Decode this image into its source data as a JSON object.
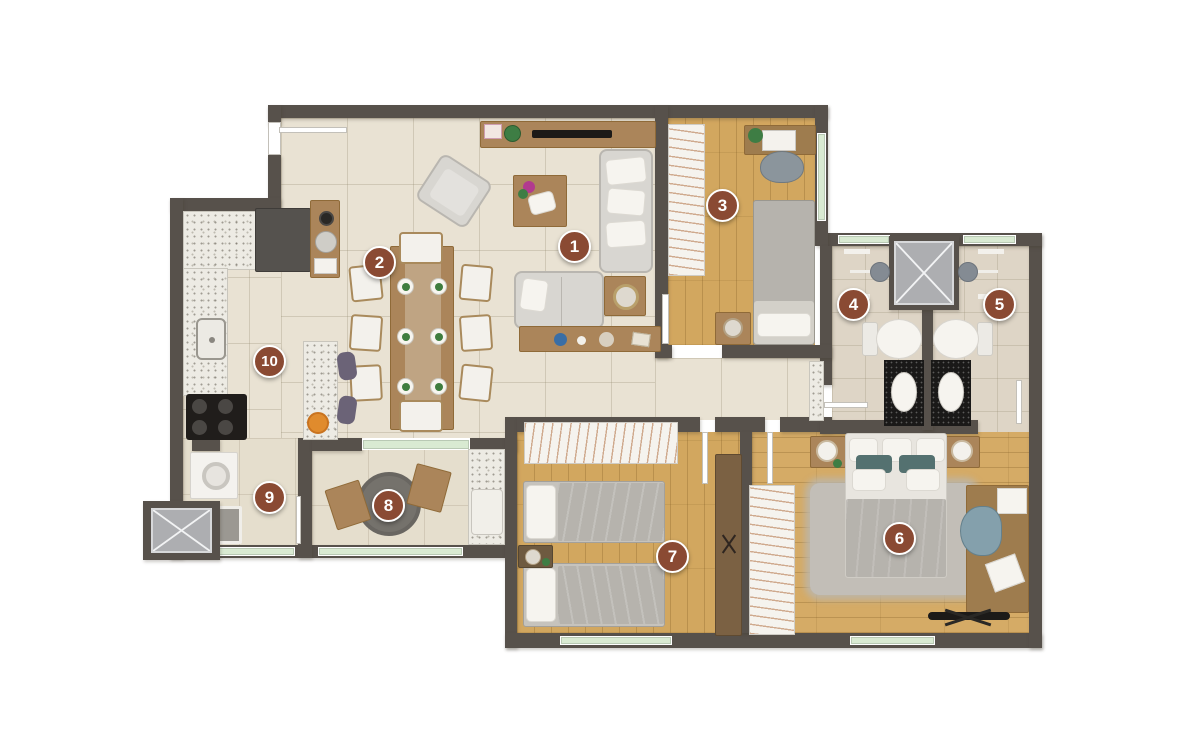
{
  "floor_plan": {
    "type": "apartment floor plan (top-down 3D render)",
    "markers": [
      {
        "label": "1"
      },
      {
        "label": "2"
      },
      {
        "label": "3"
      },
      {
        "label": "4"
      },
      {
        "label": "5"
      },
      {
        "label": "6"
      },
      {
        "label": "7"
      },
      {
        "label": "8"
      },
      {
        "label": "9"
      },
      {
        "label": "10"
      }
    ],
    "colors": {
      "wall": "#57514b",
      "tile_floor": "#e9e2d3",
      "warm_floor": "#e5decd",
      "wood_floor": "#d2a75f",
      "wood_floor_light": "#d5ab66",
      "bath_floor": "#ded5c6",
      "granite": "#edebe4",
      "marker": "#8a4a33",
      "marker_text": "#ffffff",
      "window_glass": "#d9ead2",
      "sofa_gray": "#d8d6d1",
      "bed_gray": "#b6b3ad",
      "teal_pillow": "#547170",
      "wood_furniture": "#ab855a",
      "black_counter": "#1a1918"
    }
  }
}
